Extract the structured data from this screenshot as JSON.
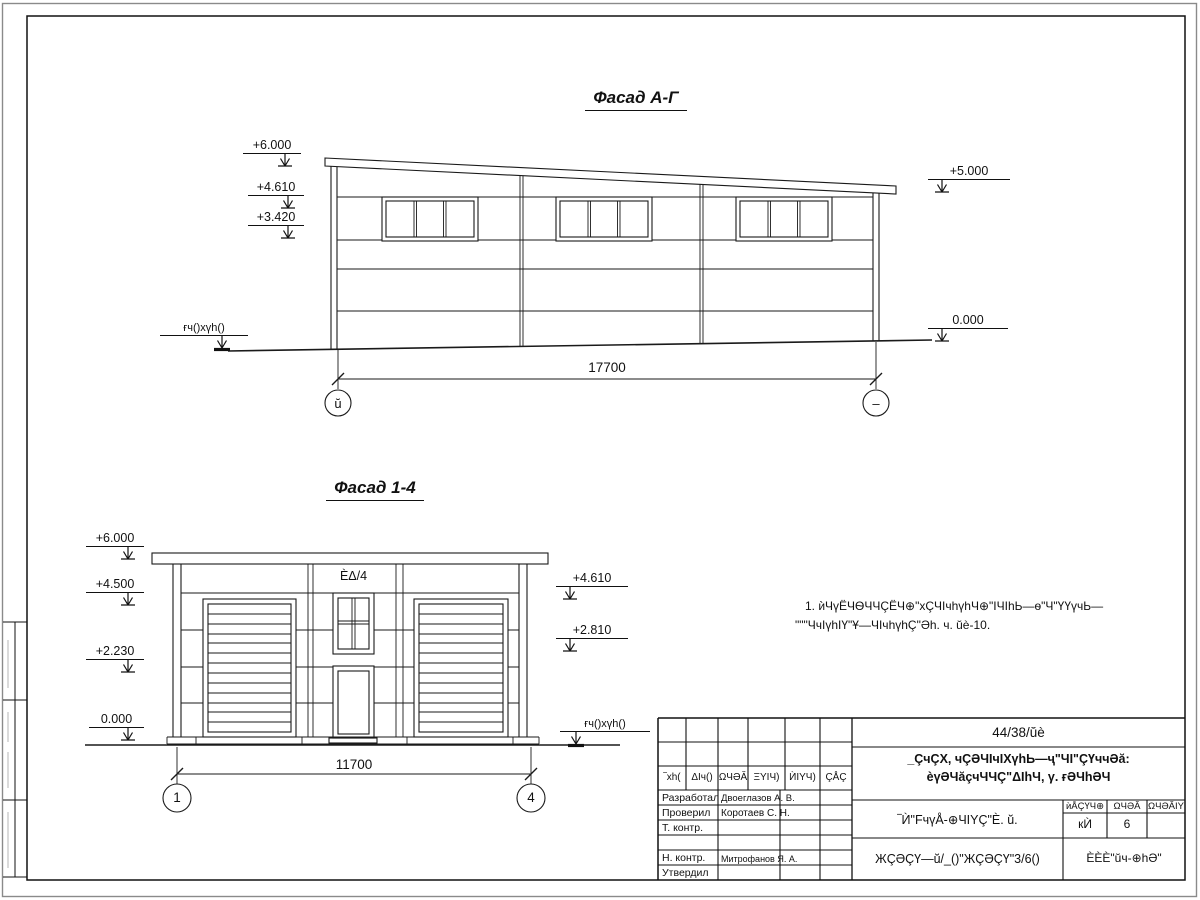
{
  "sheet": {
    "facade_ag": {
      "title": "Фасад А-Г",
      "dim": "17700",
      "axis_left": "ŭ",
      "axis_right": "–",
      "lv_6000": "+6.000",
      "lv_4610": "+4.610",
      "lv_3420": "+3.420",
      "lv_5000": "+5.000",
      "lv_0000": "0.000",
      "ground": "ғч()хүh()"
    },
    "facade_14": {
      "title": "Фасад 1-4",
      "dim": "11700",
      "axis_left": "1",
      "axis_right": "4",
      "lv_6000": "+6.000",
      "lv_4500": "+4.500",
      "lv_2230": "+2.230",
      "lv_0000": "0.000",
      "lv_4610": "+4.610",
      "lv_2810": "+2.810",
      "ground": "ғч()хүh()",
      "window_label": "ÈΔ/4"
    },
    "note": {
      "line1": "1. ѝЧүЁЧѲЧЧÇЁЧ⊕\"хÇЧΙчhүhЧ⊕\"ΙЧΙhЬ—ѳ\"Ч\"ҮҮүчЬ—",
      "line2": "\"\"\"ЧчΙүhΙҮ\"Ұ—ЧΙчhүhÇ\"Әh. ч. ŭè-10."
    },
    "titleblock": {
      "doc_number": "44/38/ŭè",
      "project_line1": "_ÇчÇХ, чÇƏЧΙчΙХүhЬ—ҷ\"ЧΙ\"ÇҮччƏă:",
      "project_line2": "èүƏЧăçчЧЧÇ\"ΔΙhЧ, γ. ғƏЧhƏЧ",
      "sheet_title": "‾Ѝ\"FчүÅ-⊕ЧΙΥÇ\"È. ŭ.",
      "stage_note": "ЖÇƏÇҮ—ŭ/_()\"ЖÇƏÇҮ\"3/6()",
      "company": "ÈÈÈ\"ŭч-⊕hƏ\"",
      "col_izm": "‾хh(",
      "col_koluch": "ΔΙч()",
      "col_list": "ΩЧƏĂ",
      "col_ndok": "ΞΥΙЧ)",
      "col_podp": "ЍΙΥЧ)",
      "col_data": "ÇÅÇ",
      "col_stage": "ѝÅÇҮЧ⊕",
      "col_sheet": "ΩЧƏĂ",
      "col_sheets": "ΩЧƏĂΙΥ",
      "stage_val": "кЍ",
      "sheet_val": "6",
      "rows": [
        {
          "role": "Разработал",
          "name": "Двоеглазов А. В."
        },
        {
          "role": "Проверил",
          "name": "Коротаев С. Н."
        },
        {
          "role": "Т. контр.",
          "name": ""
        },
        {
          "role": "Н. контр.",
          "name": "Митрофанов Я. А."
        },
        {
          "role": "Утвердил",
          "name": ""
        }
      ]
    }
  }
}
